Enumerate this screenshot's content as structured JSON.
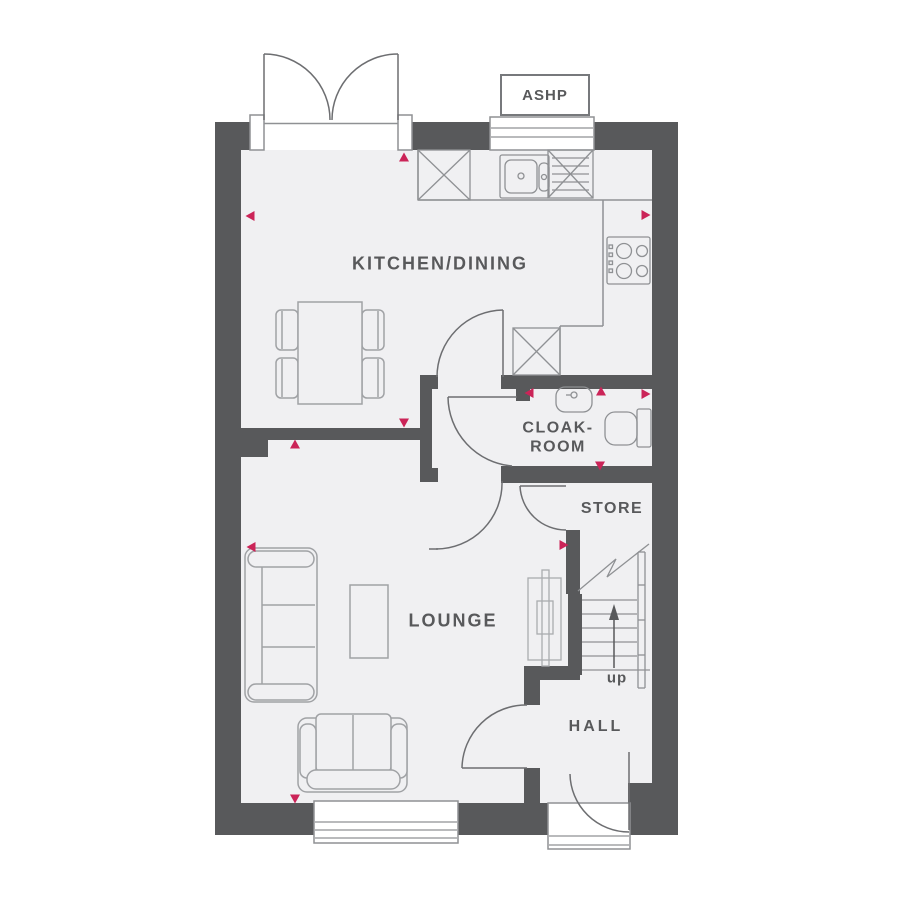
{
  "floorplan": {
    "rooms": {
      "kitchen_dining": "KITCHEN/DINING",
      "cloakroom_line1": "CLOAK-",
      "cloakroom_line2": "ROOM",
      "store": "STORE",
      "lounge": "LOUNGE",
      "hall": "HALL"
    },
    "annotations": {
      "ashp": "ASHP",
      "stairs_direction": "up"
    },
    "colors": {
      "wall": "#58595b",
      "floor": "#f0f0f2",
      "fixture_line": "#8f9194",
      "furniture_line": "#a0a2a5",
      "door_line": "#6d6e71",
      "marker": "#cb2458",
      "text": "#58595b",
      "background": "#ffffff"
    },
    "markers": [
      {
        "x": 250,
        "y": 216,
        "dir": "left"
      },
      {
        "x": 404,
        "y": 157,
        "dir": "up"
      },
      {
        "x": 646,
        "y": 215,
        "dir": "right"
      },
      {
        "x": 404,
        "y": 423,
        "dir": "down"
      },
      {
        "x": 295,
        "y": 444,
        "dir": "up"
      },
      {
        "x": 529,
        "y": 393,
        "dir": "left"
      },
      {
        "x": 601,
        "y": 391,
        "dir": "up"
      },
      {
        "x": 646,
        "y": 394,
        "dir": "right"
      },
      {
        "x": 600,
        "y": 466,
        "dir": "down"
      },
      {
        "x": 564,
        "y": 545,
        "dir": "right"
      },
      {
        "x": 251,
        "y": 547,
        "dir": "left"
      },
      {
        "x": 295,
        "y": 799,
        "dir": "down"
      }
    ]
  }
}
